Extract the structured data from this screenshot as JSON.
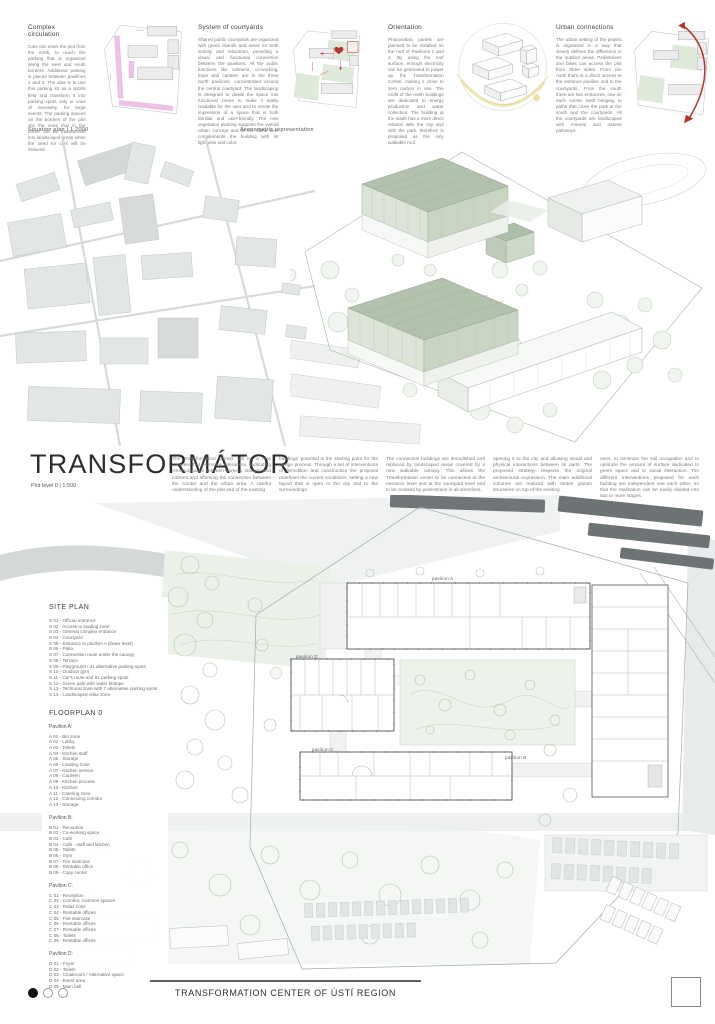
{
  "header_sections": [
    {
      "title": "Complex circulation",
      "body": "Cars can enter the plot from the north, to reach the parking that is organized along the west and south borders. Additional parking is placed between pavilions 2 and 3. The idea is to use this parking lot as a sports field and transform it into parking spots only in case of necessity, for large events. The parking spaces on the borders of the plot are the ones that in the future can be transformed into landscaped areas when the need for cars will be reduced."
    },
    {
      "title": "System of courtyards",
      "body": "Shared public courtyards are organized with green islands and areas for both activity and relaxation, providing a visual and functional connection between the pavilions. All the public functions like cafeteria, co-working, foyer and canteen are in the three north pavilions, concentrated around the central courtyard. The landscaping is designed to divide the space into functional zones to make it easily readable for the user and to create the impression of a space that is both familiar and user-friendly. The new vegetation planting supports the overall urban concept and at the same time complements the building with its lightness and color."
    },
    {
      "title": "Orientation",
      "body": "Photovoltaic panels are planned to be installed on the roof of Pavilions 1 and 2. By using the roof surface, enough electricity can be generated to power up the Transformation Center, making it close to zero carbon in use. The roofs of the north buildings are dedicated to energy production and water collection. The building at the south has a more direct relation with the city and with the park, therefore is proposed as the only walkable roof."
    },
    {
      "title": "Urban connections",
      "body": "The urban setting of the project is organized in a way that clearly defines the difference in the outdoor areas. Pedestrians and bikes can access the plot from three sides. From the north there is a direct access to the entrance pavilion and to the courtyards. From the south there are two entrances, one on each corner, both bringing to paths that cross the park at the south and the courtyards. All the courtyards are landscaped with mineral and natural pathways."
    }
  ],
  "labels": {
    "situation_plan": "Situation plan  |  1:2000",
    "axonometric": "Axonometric representation",
    "plot_level": "Plot level 0  |  1:500"
  },
  "title_block": {
    "title": "TRANSFORMÁTOR",
    "columns": [
      "The Transformation Center will be a new complex that promotes interaction, facilitating communication between workers, startups and citizens and affirming the connection between the Center and the urban area. A careful understanding of the plot and of the existing",
      "buildings' potential is the starting point for the design process. Through a set of interventions of demolition and construction the proposal redefines the current conditions, setting a new layout that is open to the city and to the surroundings.",
      "The connection buildings are demolished and replaced by landscaped areas covered by a new walkable canopy. This allows the Transformation center to be connected at the entrance level and at the courtyard level and to be crossed by pedestrians in all directions,",
      "opening it to the city and allowing visual and physical interactions between its parts. The proposed strategy respects the original architectural expression. The main additional volumes are realized with timber glulam structures on top of the existing",
      "ones, to minimize the soil occupation and to optimize the amount of surface dedicated to green space and to social interaction. The different interventions proposed for each building are independent one each other, so that the realization can be easily divided into two or more stages."
    ]
  },
  "legend": {
    "site_plan_title": "SITE PLAN",
    "site_plan_items": [
      "S 01 - Official entrance",
      "S 02 - Access to loading zone",
      "S 03 - General complex entrance",
      "S 04 - Courtyard",
      "S 05 - Entrance to pavilion A (lower level)",
      "S 06 - Patio",
      "S 07 - Connection route under the canopy",
      "S 08 - Terrace",
      "S 09 - Playground / 41 alternative parking spots",
      "S 10 - Outdoor gym",
      "S 11 - Car's route and 81 parking spots",
      "S 12 - Green park with water biotope",
      "S 13 - Technical zone with 7 alternative parking spots",
      "S 14 - Landscaped relax zone"
    ],
    "floorplan_title": "FLOORPLAN 0",
    "pavilions": [
      {
        "title": "Pavilion A:",
        "items": [
          "A 01 - Bin zone",
          "A 02 - Lobby",
          "A 03 - Toilets",
          "A 04 - Kitchen staff",
          "A 05 - Storage",
          "A 06 - Loading zone",
          "A 07 - Kitchen service",
          "A 08 - Canteen",
          "A 09 - Kitchen process",
          "A 10 - Kitchen",
          "A 11 - Catering zone",
          "A 12 - Connecting corridor",
          "A 13 - Storage"
        ]
      },
      {
        "title": "Pavilion B:",
        "items": [
          "B 01 - Reception",
          "B 02 - Co-working space",
          "B 03 - Café",
          "B 04 - Café - staff and kitchen",
          "B 05 - Toilets",
          "B 06 - Gym",
          "B 07 - Fire staircase",
          "B 08 - Rentable office",
          "B 09 - Copy center"
        ]
      },
      {
        "title": "Pavilion C:",
        "items": [
          "C 01 - Reception",
          "C 02 - Corridor, common spaces",
          "C 03 - Relax zone",
          "C 04 - Rentable offices",
          "C 05 - Fire staircase",
          "C 06 - Rentable offices",
          "C 07 - Rentable offices",
          "C 08 - Toilets",
          "C 09 - Rentable offices"
        ]
      },
      {
        "title": "Pavilion D:",
        "items": [
          "D 01 - Foyer",
          "D 02 - Toilets",
          "D 03 - Cloakroom / Alternative space",
          "D 04 - Event area",
          "D 05 - Main hall"
        ]
      }
    ]
  },
  "plan_labels": {
    "pavilion_a": "pavilion A",
    "pavilion_b": "pavilion B",
    "pavilion_c": "pavilion C",
    "pavilion_d": "pavilion D"
  },
  "footer": {
    "title": "TRANSFORMATION CENTER OF ÚSTÍ REGION",
    "pagination": {
      "total": 3,
      "current": 1
    }
  },
  "colors": {
    "accent_red": "#b8352f",
    "sage_green": "#b2c2ac",
    "courtyard_green": "#e7eee4",
    "parking_pink": "#eec2e6",
    "sun_yellow": "#e7dd9e",
    "map_gray": "#e3e6e6",
    "rail_dark": "#6d7374"
  }
}
